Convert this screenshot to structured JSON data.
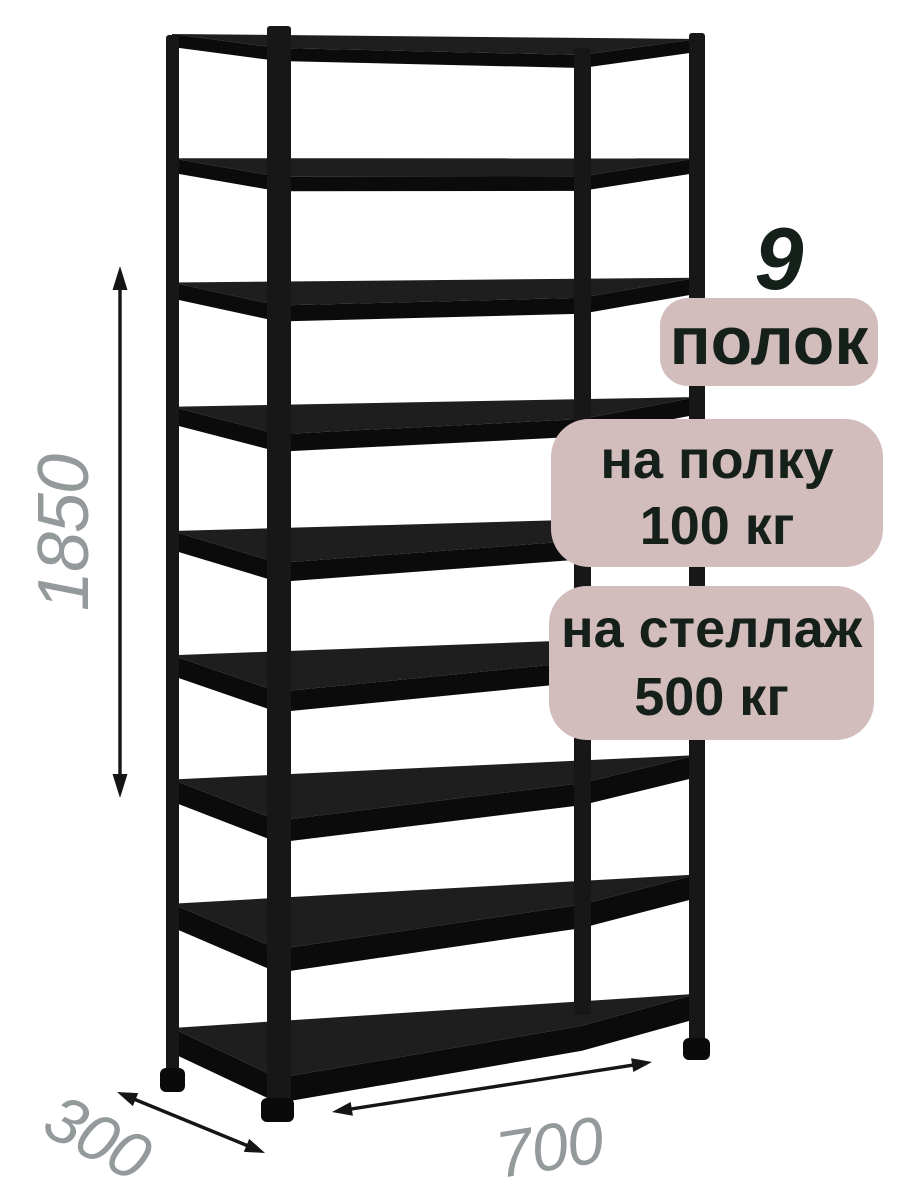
{
  "illustration": {
    "subject": "metal-shelving-rack",
    "shelf_count": 9,
    "rack_color": "#161616",
    "background_color": "#ffffff"
  },
  "callouts": {
    "badge_bg_color": "#d2bcbc",
    "text_color": "#142019",
    "shelf_count_number": "9",
    "shelf_count_label": "полок",
    "per_shelf_load": {
      "line1": "на полку",
      "line2": "100 кг"
    },
    "total_load": {
      "line1": "на стеллаж",
      "line2": "500 кг"
    }
  },
  "dimensions": {
    "label_color": "#949a9b",
    "arrow_color": "#151515",
    "height": "1850",
    "depth": "300",
    "width": "700"
  }
}
